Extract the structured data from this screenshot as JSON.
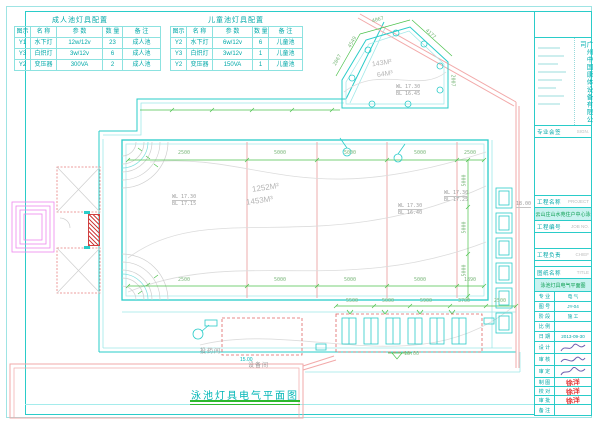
{
  "colors": {
    "cyan": "#2accc9",
    "cyan_text": "#00a8a8",
    "dim_green": "#4cc24c",
    "wall_pink": "#f2a9a9",
    "dash_red": "#e06565",
    "lane_red": "#eaa5a5",
    "shaft_magenta": "#ef86ef",
    "stamp_red": "#e23b3b",
    "signature_purple": "#6f5fae",
    "highlight_bg": "#c9f3f0",
    "highlight_text": "#0a9e4f"
  },
  "tables": {
    "adult": {
      "title": "成人池灯具配置",
      "headers": [
        "图示",
        "名 称",
        "参 数",
        "数 量",
        "备 注"
      ],
      "rows": [
        [
          "Y1",
          "水下灯",
          "12w/12v",
          "23",
          "成人池"
        ],
        [
          "Y3",
          "白炽灯",
          "3w/12v",
          "6",
          "成人池"
        ],
        [
          "Y2",
          "变压器",
          "300VA",
          "2",
          "成人池"
        ]
      ]
    },
    "child": {
      "title": "儿童池灯具配置",
      "headers": [
        "图示",
        "名 称",
        "参 数",
        "数 量",
        "备 注"
      ],
      "rows": [
        [
          "Y2",
          "水下灯",
          "6w/12v",
          "6",
          "儿童池"
        ],
        [
          "Y3",
          "白炽灯",
          "3w/12v",
          "1",
          "儿童池"
        ],
        [
          "Y2",
          "变压器",
          "150VA",
          "1",
          "儿童池"
        ]
      ]
    }
  },
  "plan": {
    "caption": "泳池灯具电气平面图",
    "main_pool": {
      "area": "1252M²",
      "volume": "1453M³",
      "levels_left": [
        "WL 17.30",
        "BL 17.15"
      ],
      "levels_mid": [
        "WL 17.30",
        "BL 16.40"
      ],
      "levels_right": [
        "WL 17.30",
        "BL 17.25"
      ]
    },
    "child_pool": {
      "area": "143M²",
      "volume": "64M³",
      "levels": [
        "WL 17.30",
        "BL 16.45"
      ],
      "dims": [
        "2067",
        "4549",
        "4067",
        "4177",
        "2007"
      ]
    },
    "top_dims": [
      "2500",
      "5000",
      "5000",
      "5000",
      "2500"
    ],
    "bottom_dims": [
      "2500",
      "5000",
      "5000",
      "5000",
      "1890"
    ],
    "lower_dims": [
      "5500",
      "5000",
      "5900",
      "3700",
      "2500"
    ],
    "right_dims": [
      "5000",
      "5000",
      "5000"
    ],
    "levels": {
      "deck": "18.00",
      "deck_right": "18.00",
      "drain": "15.00"
    },
    "rooms": {
      "dosing": "投药间",
      "equipment": "设备间"
    }
  },
  "titleblock": {
    "company": "广州中国康体设备有限公司",
    "sign_label": "专业会签",
    "sign_en": "SIGN.",
    "project_label": "工程名称",
    "project_en": "PROJECT",
    "project_name": "白云山庄山水苑住户中心泳池",
    "jobno_label": "工程编号",
    "jobno_en": "JOB NO.",
    "chief_label": "工程负责",
    "chief_en": "CHIEF",
    "title_label": "图纸名称",
    "title_en": "TITLE",
    "drawing_name": "泳池灯具电气平面图",
    "info": {
      "rows": [
        [
          "专 业",
          "电 气"
        ],
        [
          "图 号",
          "JY-04"
        ],
        [
          "阶 段",
          "施 工"
        ],
        [
          "比 例",
          ""
        ],
        [
          "日 期",
          "2013-09-30"
        ]
      ]
    },
    "signatures": [
      "设 计",
      "审 核",
      "审 定"
    ],
    "stamps": [
      {
        "label": "制 图",
        "name": "徐洋"
      },
      {
        "label": "校 对",
        "name": "徐洋"
      },
      {
        "label": "审 批",
        "name": "徐洋"
      }
    ],
    "note_label": "备 注"
  }
}
